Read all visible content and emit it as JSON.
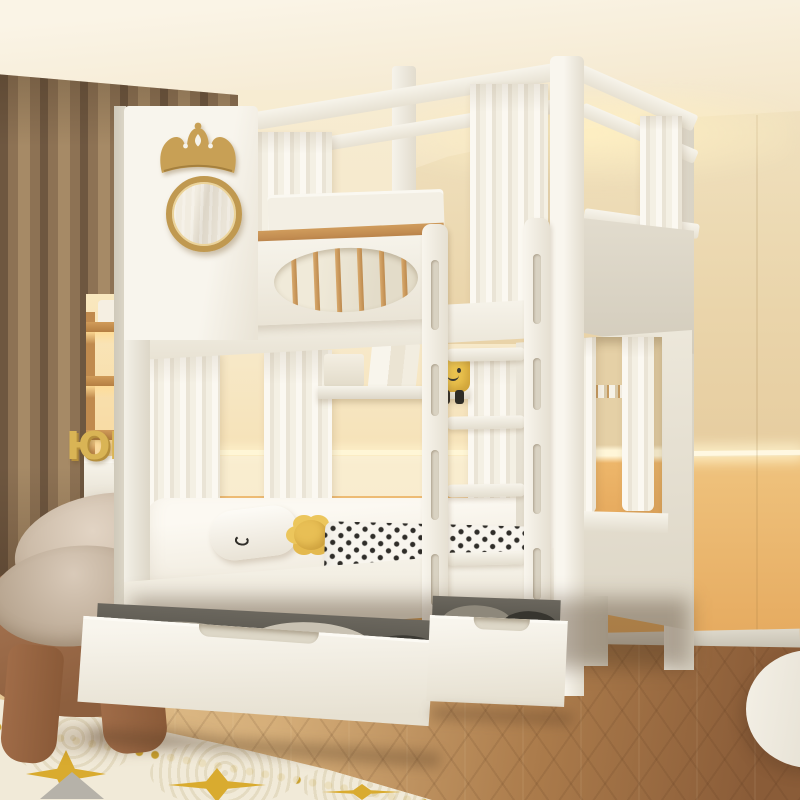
{
  "scene": {
    "type": "natural-image",
    "description": "Children's bedroom product photo: white two-tier bunk bed with canopy posts, crown and mirror decor on tall headboard, oval spindle window on upper guard rail, white ladder, white canopy curtains, two pull-out storage drawers underneath, beige room with brown curtain, wood shelving, floating desk, brown pod chair, herringbone wood floor and cream rug with gold stars",
    "decor_letters_text": "ЮМ",
    "palette": {
      "bed_white": "#f3f0e8",
      "bed_shade": "#ddd7c8",
      "wood_accent": "#c8945a",
      "gold_decor": "#c8a055",
      "wall_upper_beige": "#ead5ab",
      "wall_lower_orange": "#e8ad61",
      "led_glow": "#fff8e2",
      "curtain_brown": "#8d7254",
      "white_curtain": "#f4f0e4",
      "floor_light": "#d5ae79",
      "floor_dark": "#8a5c38",
      "rug_cream": "#f1ead8",
      "rug_gold": "#d9ab2f",
      "chair_brown": "#9a6a48",
      "cushion_beige": "#d2c3b1",
      "plush_yellow": "#eac24e",
      "blanket_dot": "#2f2d29"
    }
  }
}
